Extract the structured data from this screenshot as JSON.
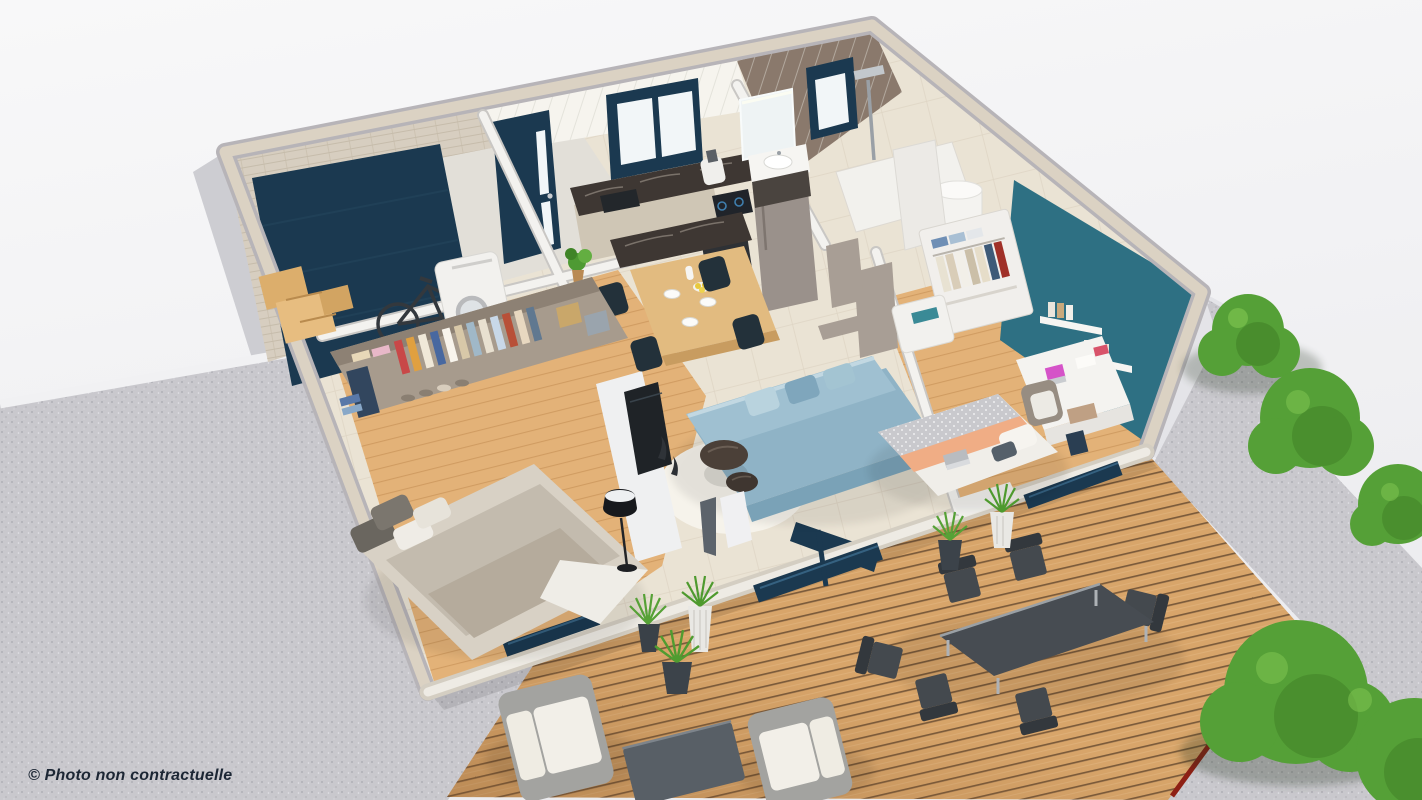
{
  "caption": {
    "text": "© Photo non contractuelle"
  },
  "scene": {
    "type": "3d-floor-plan-render",
    "rooms": [
      "garage",
      "entrance",
      "kitchen-dining",
      "bathroom",
      "hallway",
      "bedroom-1",
      "living-room",
      "bedroom-2",
      "terrace",
      "garden"
    ]
  },
  "palette": {
    "gravel": "#c9c8cd",
    "deck_wood": "#d8a56a",
    "deck_border": "#8e2015",
    "wall_top": "#dbd2c3",
    "wall_face": "#cdcdd2",
    "wall_front": "#e9e9ec",
    "wall_planks": "#f2f1ee",
    "floor_tile": "#eae3d4",
    "floor_wood": "#e3b278",
    "floor_concrete": "#e2dfd8",
    "navy": "#1b3950",
    "teal": "#2e7083",
    "tile_brown": "#8a796c",
    "marble": "#3e3733",
    "cabinet": "#cfc6b5",
    "fridge": "#9a918b",
    "sofa": "#8fb3c6",
    "rug": "#f6f3eb",
    "bedding_gray": "#d8d1c5",
    "bedding_peach": "#f0ad85",
    "door_taupe": "#a89e95",
    "green": "#55a037",
    "green_dark": "#3f7d26",
    "outdoor_gray": "#44494e",
    "rattan": "#a3a3a0",
    "cushion": "#efece3",
    "lamp": "#17191d",
    "caption_color": "#1c2634"
  }
}
